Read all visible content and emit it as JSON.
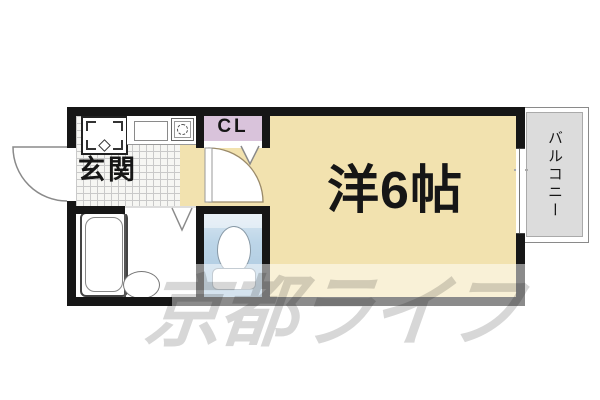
{
  "floor_plan": {
    "kind": "Japanese apartment floor plan (1K / one-room layout)",
    "labels": {
      "entrance": "玄関",
      "closet": "CL",
      "main_room": "洋6帖",
      "balcony": "バルコニー"
    },
    "watermark": "京都ライフ",
    "fixtures": [
      "washing-machine-pan",
      "kitchen-sink",
      "single-burner-stove",
      "bathtub",
      "washbasin",
      "toilet",
      "entrance-door",
      "room-door",
      "closet-folding-door",
      "sliding-window"
    ],
    "colors": {
      "wall": "#161616",
      "room_floor": "#F2E2AF",
      "closet_floor": "#D9C3DB",
      "toilet_floor": "#BCD5E8",
      "balcony_floor": "#DCDCDC",
      "tile_line": "#C9C9C9",
      "watermark": "#D7D7D7"
    }
  }
}
